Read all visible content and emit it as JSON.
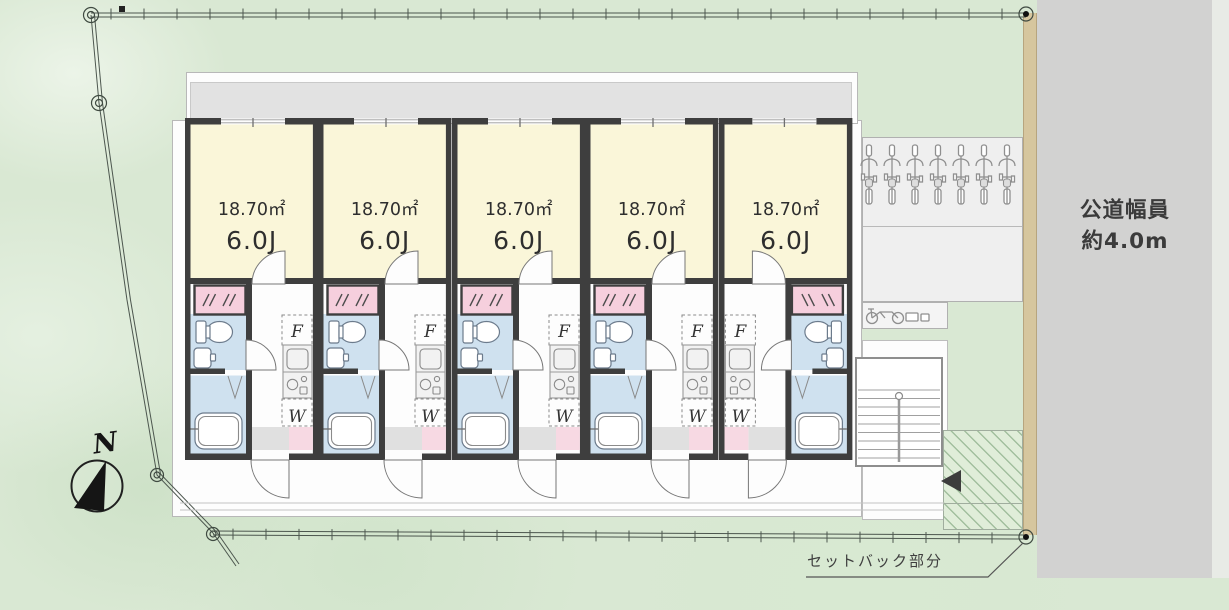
{
  "road": {
    "label_line1": "公道幅員",
    "label_line2": "約4.0m"
  },
  "setback": {
    "label": "セットバック部分"
  },
  "compass": {
    "north_label": "N"
  },
  "building": {
    "fridge_label": "F",
    "washer_label": "W",
    "units": [
      {
        "area": "18.70㎡",
        "size": "6.0J",
        "mirrored": false
      },
      {
        "area": "18.70㎡",
        "size": "6.0J",
        "mirrored": false
      },
      {
        "area": "18.70㎡",
        "size": "6.0J",
        "mirrored": false
      },
      {
        "area": "18.70㎡",
        "size": "6.0J",
        "mirrored": false
      },
      {
        "area": "18.70㎡",
        "size": "6.0J",
        "mirrored": true
      }
    ]
  },
  "exterior": {
    "bike_rack_count": 7,
    "side_bike_count": 1
  },
  "colors": {
    "site_green": "#d9e8d3",
    "road_gray": "#d2d2d1",
    "boundary_tan": "#d6c69e",
    "balcony_gray": "#e2e2e2",
    "room_yellow": "#faf6d9",
    "wet_blue": "#cfe1ef",
    "closet_pink": "#f6cfdd",
    "wall_color": "#3e3e3e",
    "hatch_green": "#a2bf9e"
  }
}
